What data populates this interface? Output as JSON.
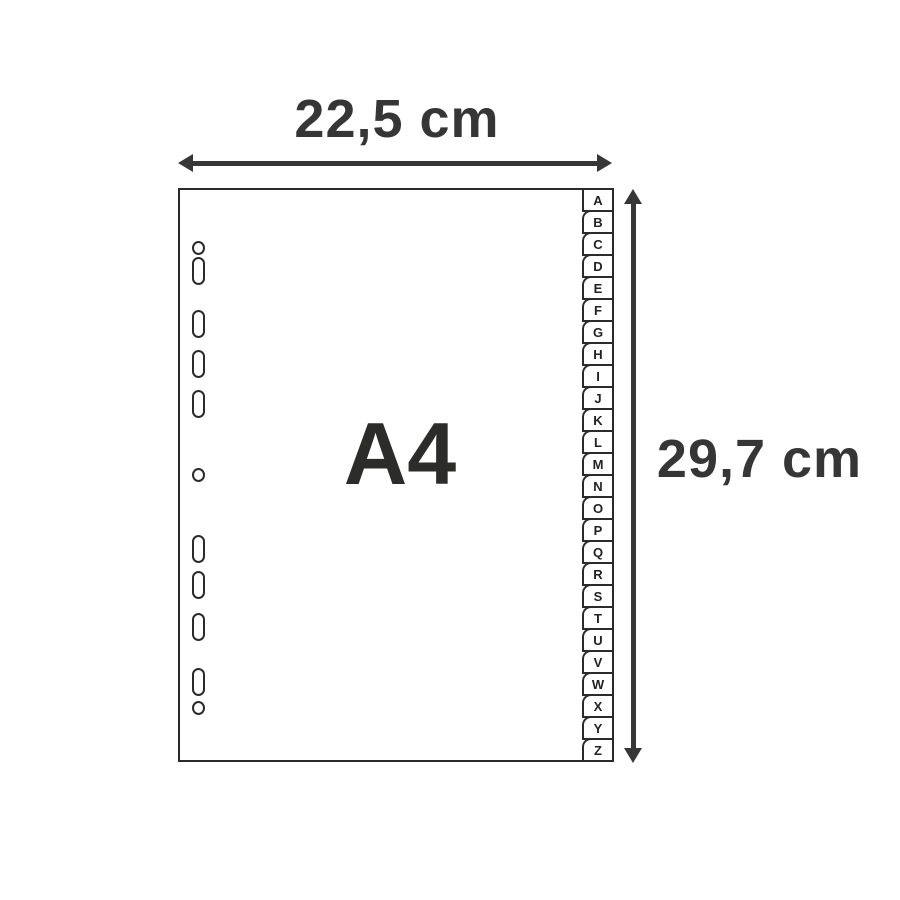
{
  "diagram": {
    "sheet_label": "A4",
    "dimensions": {
      "width_label": "22,5 cm",
      "height_label": "29,7 cm"
    },
    "index_tabs": [
      "A",
      "B",
      "C",
      "D",
      "E",
      "F",
      "G",
      "H",
      "I",
      "J",
      "K",
      "L",
      "M",
      "N",
      "O",
      "P",
      "Q",
      "R",
      "S",
      "T",
      "U",
      "V",
      "W",
      "X",
      "Y",
      "Z"
    ],
    "punch_holes": [
      {
        "type": "round",
        "top": 51
      },
      {
        "type": "oblong",
        "top": 67
      },
      {
        "type": "oblong",
        "top": 120
      },
      {
        "type": "oblong",
        "top": 160
      },
      {
        "type": "oblong",
        "top": 200
      },
      {
        "type": "round",
        "top": 278
      },
      {
        "type": "oblong",
        "top": 345
      },
      {
        "type": "oblong",
        "top": 381
      },
      {
        "type": "oblong",
        "top": 423
      },
      {
        "type": "oblong",
        "top": 478
      },
      {
        "type": "round",
        "top": 511
      }
    ],
    "colors": {
      "outline": "#2b2b2b",
      "dimension": "#363636",
      "sheet_fill": "#ffffff",
      "background": "#ffffff"
    }
  }
}
